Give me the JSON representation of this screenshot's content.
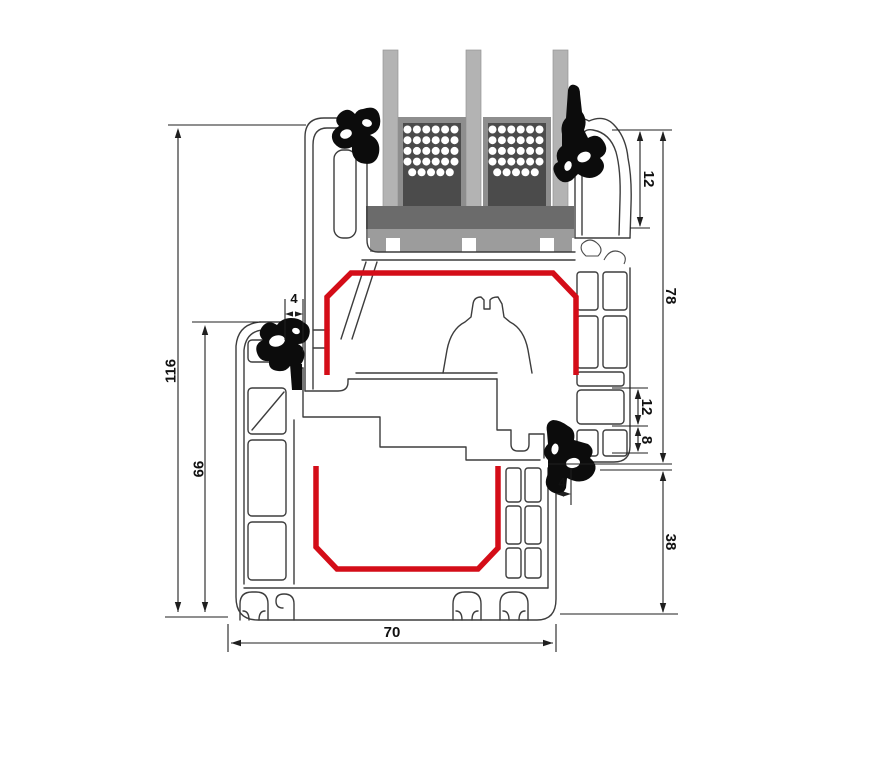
{
  "drawing": {
    "type": "window-profile-cross-section",
    "colors": {
      "outline": "#3d3d3d",
      "dimension": "#1f1f1f",
      "steel": "#d40d18",
      "glass": "#b3b3b3",
      "spacer_frame": "#8e8e8e",
      "spacer_core": "#4b4b4b",
      "glazing_block": "#6b6b6b",
      "setting_block": "#9c9c9c",
      "gasket": "#0c0c0c",
      "background": "#ffffff"
    },
    "dimensions": {
      "total_height": "116",
      "frame_section_height": "66",
      "gasket_overlap_top": "4",
      "glazing_bead_height": "12",
      "sash_section_height": "78",
      "chamber_height_12": "12",
      "chamber_height_8": "8",
      "frame_face_height": "38",
      "gasket_overlap_bottom": "4",
      "profile_depth": "70"
    }
  }
}
